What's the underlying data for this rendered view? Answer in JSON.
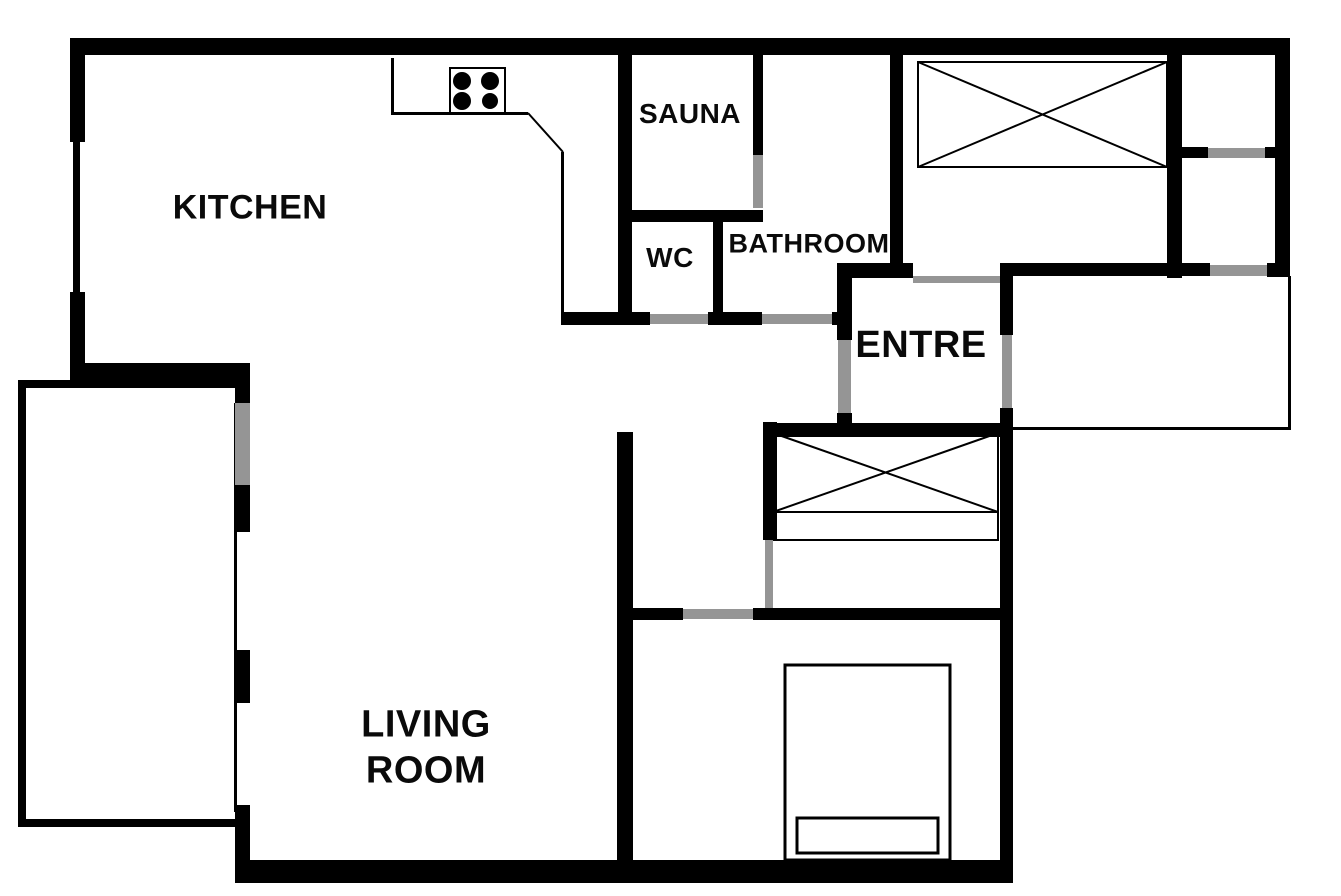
{
  "canvas": {
    "width": 1341,
    "height": 896,
    "background": "#ffffff"
  },
  "palette": {
    "wall": "#000000",
    "door_opening": "#959595",
    "label_text": "#0a0a0a"
  },
  "rooms": [
    {
      "id": "kitchen",
      "label": "KITCHEN",
      "cx": 250,
      "cy": 208,
      "size": 34
    },
    {
      "id": "sauna",
      "label": "SAUNA",
      "cx": 690,
      "cy": 114,
      "size": 28
    },
    {
      "id": "wc",
      "label": "WC",
      "cx": 670,
      "cy": 258,
      "size": 28
    },
    {
      "id": "bathroom",
      "label": "BATHROOM",
      "cx": 809,
      "cy": 244,
      "size": 27
    },
    {
      "id": "entre",
      "label": "ENTRE",
      "cx": 921,
      "cy": 345,
      "size": 38
    },
    {
      "id": "living-room",
      "label": "LIVING\nROOM",
      "cx": 426,
      "cy": 748,
      "size": 38
    }
  ],
  "walls": [
    {
      "name": "outer-wall-top",
      "x": 70,
      "y": 38,
      "w": 1220,
      "h": 17
    },
    {
      "name": "outer-wall-left-upper",
      "x": 70,
      "y": 38,
      "w": 15,
      "h": 104
    },
    {
      "name": "outer-wall-left-lower",
      "x": 70,
      "y": 292,
      "w": 15,
      "h": 88
    },
    {
      "name": "kitchen-south-wall",
      "x": 73,
      "y": 363,
      "w": 177,
      "h": 17
    },
    {
      "name": "living-west-pier-1",
      "x": 235,
      "y": 368,
      "w": 15,
      "h": 35
    },
    {
      "name": "living-west-pier-2",
      "x": 235,
      "y": 485,
      "w": 15,
      "h": 47
    },
    {
      "name": "living-west-pier-3",
      "x": 235,
      "y": 650,
      "w": 15,
      "h": 53
    },
    {
      "name": "living-west-pier-4",
      "x": 235,
      "y": 805,
      "w": 15,
      "h": 70
    },
    {
      "name": "outer-wall-bottom",
      "x": 235,
      "y": 860,
      "w": 778,
      "h": 23
    },
    {
      "name": "living-east-wall",
      "x": 617,
      "y": 432,
      "w": 16,
      "h": 431
    },
    {
      "name": "sauna-west-wall",
      "x": 618,
      "y": 55,
      "w": 14,
      "h": 257
    },
    {
      "name": "sauna-south-wall",
      "x": 618,
      "y": 210,
      "w": 145,
      "h": 12
    },
    {
      "name": "sauna-east-wall",
      "x": 753,
      "y": 55,
      "w": 10,
      "h": 100
    },
    {
      "name": "wc-east-wall",
      "x": 713,
      "y": 218,
      "w": 10,
      "h": 97
    },
    {
      "name": "hall-north-wall-west",
      "x": 561,
      "y": 312,
      "w": 89,
      "h": 13
    },
    {
      "name": "hall-north-wall-mid",
      "x": 708,
      "y": 312,
      "w": 54,
      "h": 13
    },
    {
      "name": "hall-north-wall-corner",
      "x": 832,
      "y": 312,
      "w": 20,
      "h": 13
    },
    {
      "name": "bathroom-east-wall",
      "x": 890,
      "y": 55,
      "w": 13,
      "h": 208
    },
    {
      "name": "entre-north-wall",
      "x": 837,
      "y": 263,
      "w": 76,
      "h": 15
    },
    {
      "name": "entre-west-wall-upper",
      "x": 837,
      "y": 278,
      "w": 15,
      "h": 62
    },
    {
      "name": "entre-west-wall-lower",
      "x": 837,
      "y": 413,
      "w": 15,
      "h": 24
    },
    {
      "name": "entre-south-wall",
      "x": 765,
      "y": 423,
      "w": 235,
      "h": 14
    },
    {
      "name": "entre-east-wall-upper",
      "x": 1000,
      "y": 263,
      "w": 13,
      "h": 72
    },
    {
      "name": "bedroom-east-wall",
      "x": 1000,
      "y": 408,
      "w": 13,
      "h": 464
    },
    {
      "name": "closet-west-wall",
      "x": 763,
      "y": 422,
      "w": 14,
      "h": 118
    },
    {
      "name": "bedroom-north-wall-west",
      "x": 633,
      "y": 608,
      "w": 50,
      "h": 12
    },
    {
      "name": "bedroom-north-wall-east",
      "x": 753,
      "y": 608,
      "w": 247,
      "h": 12
    },
    {
      "name": "storage-south-wall",
      "x": 1000,
      "y": 263,
      "w": 210,
      "h": 13
    },
    {
      "name": "storage-corner-ne",
      "x": 1267,
      "y": 263,
      "w": 23,
      "h": 14
    },
    {
      "name": "closetroom-east-wall",
      "x": 1167,
      "y": 55,
      "w": 15,
      "h": 223
    },
    {
      "name": "outer-wall-right",
      "x": 1275,
      "y": 38,
      "w": 15,
      "h": 239
    },
    {
      "name": "tr-divider-west",
      "x": 1173,
      "y": 147,
      "w": 35,
      "h": 11
    },
    {
      "name": "tr-divider-east",
      "x": 1265,
      "y": 147,
      "w": 15,
      "h": 11
    }
  ],
  "doors": [
    {
      "name": "balcony-door",
      "x": 235,
      "y": 403,
      "w": 15,
      "h": 82
    },
    {
      "name": "wc-door",
      "x": 650,
      "y": 314,
      "w": 58,
      "h": 10
    },
    {
      "name": "bathroom-door",
      "x": 762,
      "y": 314,
      "w": 70,
      "h": 10
    },
    {
      "name": "sauna-door",
      "x": 753,
      "y": 155,
      "w": 10,
      "h": 53
    },
    {
      "name": "entre-west-door",
      "x": 838,
      "y": 340,
      "w": 13,
      "h": 73
    },
    {
      "name": "entre-north-opening",
      "x": 913,
      "y": 276,
      "w": 87,
      "h": 7
    },
    {
      "name": "entre-east-door",
      "x": 1002,
      "y": 335,
      "w": 10,
      "h": 73
    },
    {
      "name": "hall-closet-door",
      "x": 765,
      "y": 540,
      "w": 8,
      "h": 68
    },
    {
      "name": "bedroom-door",
      "x": 683,
      "y": 609,
      "w": 70,
      "h": 10
    },
    {
      "name": "storage-door",
      "x": 1210,
      "y": 265,
      "w": 57,
      "h": 11
    },
    {
      "name": "tr-divider-door",
      "x": 1208,
      "y": 148,
      "w": 57,
      "h": 10
    }
  ],
  "thin_bars": [
    {
      "name": "kitchen-window",
      "x": 73,
      "y": 142,
      "w": 7,
      "h": 150
    },
    {
      "name": "living-window-strip",
      "x": 234,
      "y": 403,
      "w": 3,
      "h": 409
    },
    {
      "name": "balcony-rail-left",
      "x": 18,
      "y": 380,
      "w": 8,
      "h": 447
    },
    {
      "name": "balcony-rail-top",
      "x": 18,
      "y": 380,
      "w": 219,
      "h": 8
    },
    {
      "name": "balcony-rail-bottom",
      "x": 18,
      "y": 819,
      "w": 219,
      "h": 8
    },
    {
      "name": "counter-edge-left",
      "x": 391,
      "y": 58,
      "w": 3,
      "h": 57
    },
    {
      "name": "counter-edge-front",
      "x": 391,
      "y": 112,
      "w": 137,
      "h": 3
    },
    {
      "name": "cabinet-edge",
      "x": 561,
      "y": 152,
      "w": 3,
      "h": 161
    },
    {
      "name": "storage-rail-right",
      "x": 1288,
      "y": 276,
      "w": 3,
      "h": 154
    },
    {
      "name": "storage-rail-bottom",
      "x": 1013,
      "y": 427,
      "w": 278,
      "h": 3
    }
  ],
  "outline_rects": [
    {
      "name": "stove-outline",
      "x": 450,
      "y": 68,
      "w": 55,
      "h": 45,
      "sw": 2
    },
    {
      "name": "wardrobe-closetroom",
      "x": 918,
      "y": 62,
      "w": 249,
      "h": 105,
      "sw": 2
    },
    {
      "name": "wardrobe-hall",
      "x": 773,
      "y": 433,
      "w": 225,
      "h": 79,
      "sw": 2
    },
    {
      "name": "wardrobe-hall-shelf",
      "x": 773,
      "y": 512,
      "w": 225,
      "h": 28,
      "sw": 2
    },
    {
      "name": "bed-outline",
      "x": 785,
      "y": 665,
      "w": 165,
      "h": 195,
      "sw": 3
    },
    {
      "name": "bed-footboard",
      "x": 797,
      "y": 818,
      "w": 141,
      "h": 35,
      "sw": 3
    }
  ],
  "lines": [
    {
      "name": "wardrobe-closetroom-diag-1",
      "x1": 918,
      "y1": 62,
      "x2": 1167,
      "y2": 167
    },
    {
      "name": "wardrobe-closetroom-diag-2",
      "x1": 918,
      "y1": 167,
      "x2": 1167,
      "y2": 62
    },
    {
      "name": "wardrobe-hall-diag-1",
      "x1": 773,
      "y1": 433,
      "x2": 998,
      "y2": 512
    },
    {
      "name": "wardrobe-hall-diag-2",
      "x1": 773,
      "y1": 512,
      "x2": 998,
      "y2": 433
    },
    {
      "name": "counter-diagonal",
      "x1": 528,
      "y1": 113,
      "x2": 563,
      "y2": 152
    }
  ],
  "circles": [
    {
      "name": "stove-burner-tl",
      "cx": 462,
      "cy": 81,
      "r": 9
    },
    {
      "name": "stove-burner-tr",
      "cx": 490,
      "cy": 81,
      "r": 9
    },
    {
      "name": "stove-burner-bl",
      "cx": 462,
      "cy": 101,
      "r": 9
    },
    {
      "name": "stove-burner-br",
      "cx": 490,
      "cy": 101,
      "r": 8
    }
  ]
}
